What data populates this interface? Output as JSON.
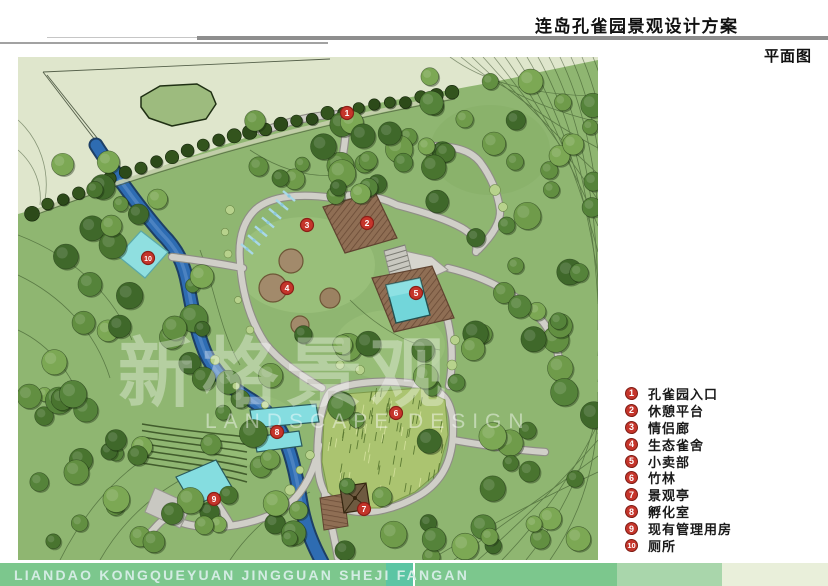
{
  "header": {
    "title": "连岛孔雀园景观设计方案",
    "subtitle": "平面图"
  },
  "watermark": {
    "cn": "新格景观",
    "en": "LANDSCAPE DESIGN"
  },
  "legend": {
    "items": [
      {
        "num": "1",
        "label": "孔雀园入口"
      },
      {
        "num": "2",
        "label": "休憩平台"
      },
      {
        "num": "3",
        "label": "情侣廊"
      },
      {
        "num": "4",
        "label": "生态雀舍"
      },
      {
        "num": "5",
        "label": "小卖部"
      },
      {
        "num": "6",
        "label": "竹林"
      },
      {
        "num": "7",
        "label": "景观亭"
      },
      {
        "num": "8",
        "label": "孵化室"
      },
      {
        "num": "9",
        "label": "现有管理用房"
      },
      {
        "num": "10",
        "label": "厕所"
      }
    ]
  },
  "map": {
    "markers": [
      {
        "num": "1",
        "label": "孔雀园入口",
        "x": 347,
        "y": 113
      },
      {
        "num": "2",
        "label": "休憩平台",
        "x": 367,
        "y": 223
      },
      {
        "num": "3",
        "label": "情侣廊",
        "x": 307,
        "y": 225
      },
      {
        "num": "4",
        "label": "生态雀舍",
        "x": 287,
        "y": 288
      },
      {
        "num": "5",
        "label": "小卖部",
        "x": 416,
        "y": 293
      },
      {
        "num": "6",
        "label": "竹林",
        "x": 396,
        "y": 413
      },
      {
        "num": "7",
        "label": "景观亭",
        "x": 364,
        "y": 509
      },
      {
        "num": "8",
        "label": "孵化室",
        "x": 277,
        "y": 432
      },
      {
        "num": "9",
        "label": "现有管理用房",
        "x": 214,
        "y": 499
      },
      {
        "num": "10",
        "label": "厕所",
        "x": 148,
        "y": 258
      }
    ]
  },
  "footer": {
    "text": "LIANDAO KONGQUEYUAN JINGGUAN SHEJI FANGAN"
  },
  "colors": {
    "marker_red": "#c5352b",
    "water_blue": "#2e6cb2",
    "building_cyan": "#85dde0",
    "park_green": "#8fb671",
    "pale_green": "#dfe6cc",
    "footer_green": "#7cc78d",
    "footer_green_mid": "#a9d6ab",
    "footer_green_pale": "#e9efda",
    "footer_accent_teal": "#5cc5a4"
  }
}
